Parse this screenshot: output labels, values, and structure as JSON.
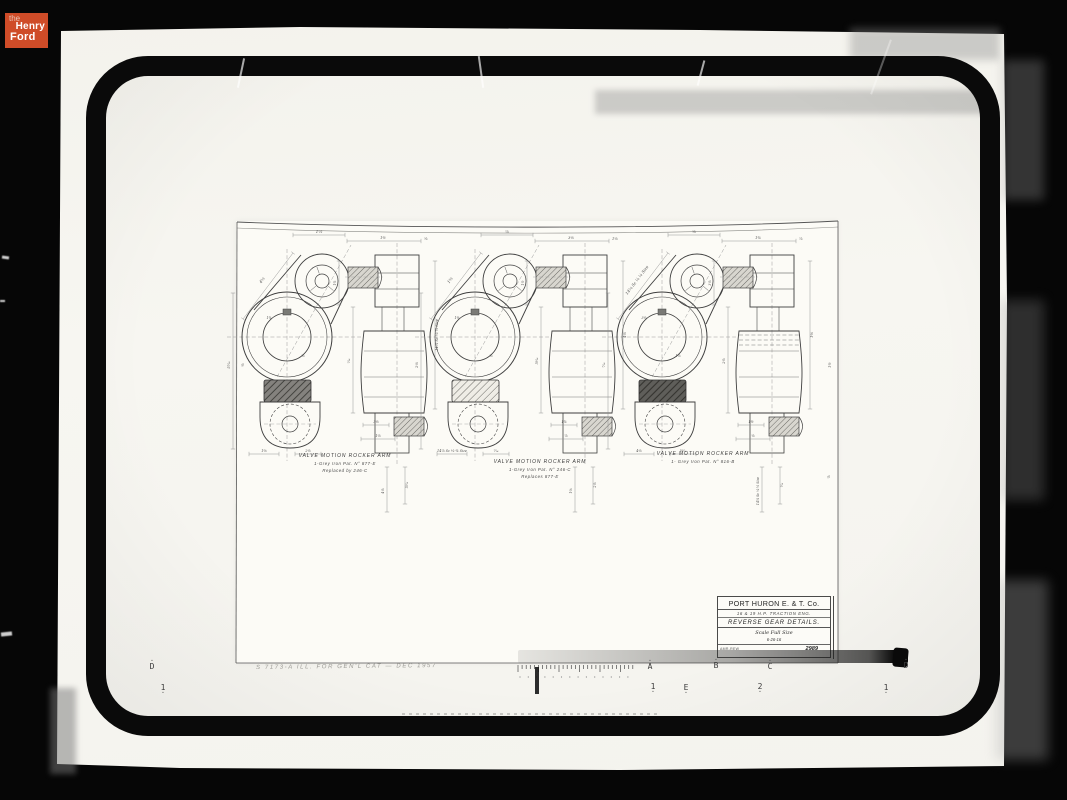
{
  "logo": {
    "line1": "the",
    "line2": "Henry",
    "line3": "Ford"
  },
  "drawing": {
    "assemblies": [
      {
        "lines": [
          "VALVE MOTION ROCKER ARM",
          "1-Grey Iron  Pat. N° 877-E",
          "Replaced by 246-C"
        ],
        "block": "dark"
      },
      {
        "lines": [
          "VALVE MOTION ROCKER ARM",
          "1-Grey Iron  Pat. N° 246-C",
          "Replaces 877-E"
        ],
        "block": "hatch"
      },
      {
        "lines": [
          "VALVE MOTION ROCKER ARM",
          "1- Grey Iron   Pat. N° 816-B",
          ""
        ],
        "block": "darkhatch"
      }
    ],
    "title_block": {
      "company": "PORT HURON E. & T. Co.",
      "line2": "16 & 19 H.P. TRACTION ENG.",
      "line3": "REVERSE GEAR DETAILS.",
      "scale": "Scale Full Size",
      "date": "6-26-16",
      "code_left": "AMR-REW",
      "number": "2989"
    },
    "dim_labels": [
      "1⅝",
      "4⅛",
      "5¹⁄₁₆",
      "1¾",
      "⅞",
      "1⅜",
      "2⅛",
      "1½",
      "⅝",
      "14⅞ Sc ⅛ ¼ Size",
      "⁷⁄₁₆",
      "3⅛"
    ]
  },
  "annotations": {
    "pencil_note": "S 7173-A  ILL. FOR GEN'L CAT  —  DEC 1957",
    "reg_left_top": "D",
    "reg_left_bottom": "1",
    "reg_top": [
      "A",
      "B",
      "C",
      "D"
    ],
    "reg_bottom": [
      "1",
      "E",
      "2",
      "1"
    ]
  }
}
